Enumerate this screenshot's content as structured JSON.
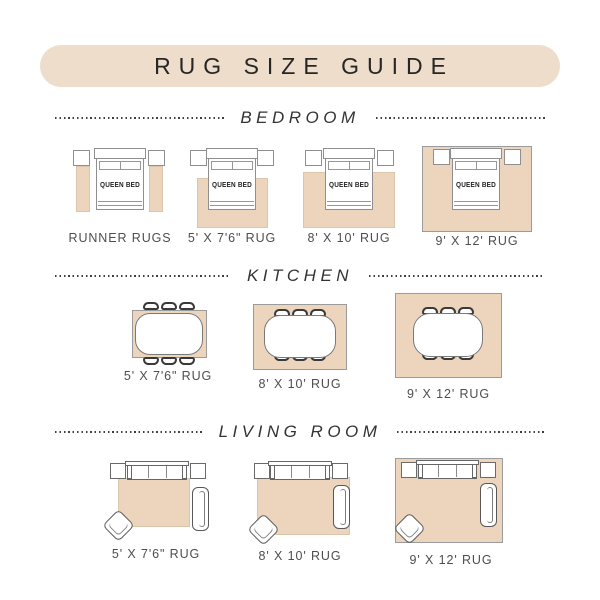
{
  "banner": {
    "title": "RUG SIZE GUIDE",
    "bg": "#eeddcb"
  },
  "bed_label": "QUEEN BED",
  "colors": {
    "banner_bg": "#eeddcb",
    "rug_fill": "#ecd5bc",
    "outline_gray": "#8f8f8f",
    "furniture_dark": "#3a3a3a",
    "heading_text": "#333333",
    "label_text": "#4e4e4e",
    "dots": "#3f3f3f"
  },
  "sections": [
    {
      "title": "BEDROOM",
      "items": [
        {
          "label": "RUNNER RUGS"
        },
        {
          "label": "5' X 7'6\" RUG"
        },
        {
          "label": "8' X 10' RUG"
        },
        {
          "label": "9' X 12' RUG"
        }
      ]
    },
    {
      "title": "KITCHEN",
      "items": [
        {
          "label": "5' X 7'6\" RUG"
        },
        {
          "label": "8' X 10' RUG"
        },
        {
          "label": "9' X 12' RUG"
        }
      ]
    },
    {
      "title": "LIVING ROOM",
      "items": [
        {
          "label": "5' X 7'6\" RUG"
        },
        {
          "label": "8' X 10' RUG"
        },
        {
          "label": "9' X 12' RUG"
        }
      ]
    }
  ]
}
